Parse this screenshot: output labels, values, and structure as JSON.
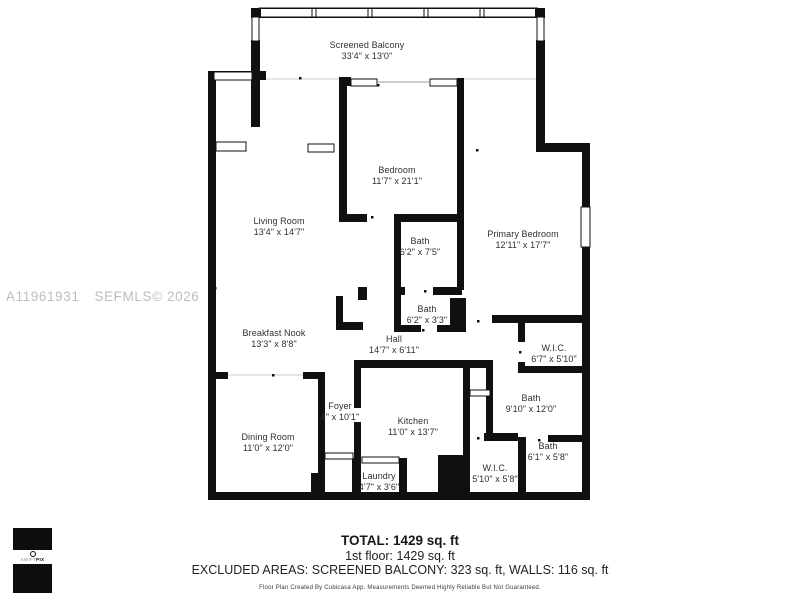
{
  "watermark": {
    "listing_id": "A11961931",
    "mls": "SEFMLS© 2026"
  },
  "rooms": [
    {
      "name": "Screened Balcony",
      "dims": "33'4\" x 13'0\""
    },
    {
      "name": "Bedroom",
      "dims": "11'7\" x 21'1\""
    },
    {
      "name": "Living Room",
      "dims": "13'4\" x 14'7\""
    },
    {
      "name": "Primary Bedroom",
      "dims": "12'11\" x 17'7\""
    },
    {
      "name": "Bath",
      "dims": "6'2\" x 7'5\""
    },
    {
      "name": "Bath",
      "dims": "6'2\" x 3'3\""
    },
    {
      "name": "Breakfast Nook",
      "dims": "13'3\" x 8'8\""
    },
    {
      "name": "Hall",
      "dims": "14'7\" x 6'11\""
    },
    {
      "name": "W.I.C.",
      "dims": "6'7\" x 5'10\""
    },
    {
      "name": "Bath",
      "dims": "9'10\" x 12'0\""
    },
    {
      "name": "Foyer",
      "dims": "4\" x 10'1\""
    },
    {
      "name": "Kitchen",
      "dims": "11'0\" x 13'7\""
    },
    {
      "name": "Dining Room",
      "dims": "11'0\" x 12'0\""
    },
    {
      "name": "Bath",
      "dims": "6'1\" x 5'8\""
    },
    {
      "name": "W.I.C.",
      "dims": "5'10\" x 5'8\""
    },
    {
      "name": "Laundry",
      "dims": "4'7\" x 3'6\""
    }
  ],
  "summary": {
    "total": "TOTAL: 1429 sq. ft",
    "first_floor": "1st floor: 1429 sq. ft",
    "excluded": "EXCLUDED AREAS: SCREENED BALCONY: 323 sq. ft, WALLS: 116 sq. ft",
    "disclaimer": "Floor Plan Created By Cubicasa App. Measurements Deemed Highly Reliable But Not Guaranteed."
  },
  "logo": {
    "brand_light": "SWIFT",
    "brand_bold": "PIX"
  },
  "colors": {
    "wall": "#101010",
    "label": "#2f2f2f",
    "watermark": "#bdbdbd"
  }
}
